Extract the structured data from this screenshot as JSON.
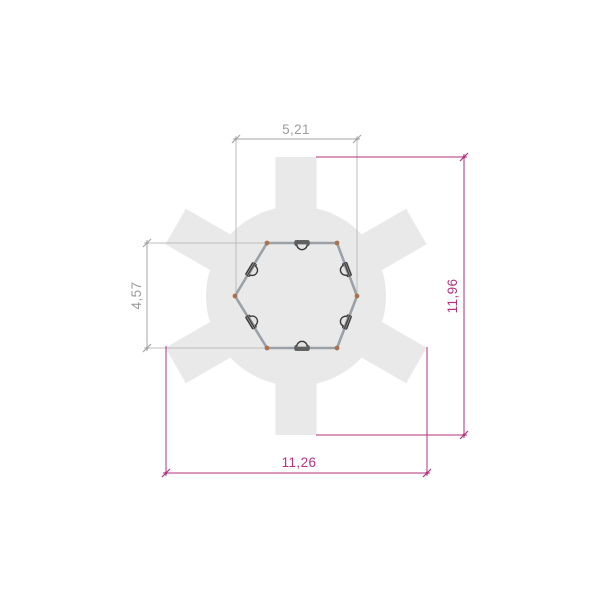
{
  "drawing": {
    "kind": "dimensioned top-view plan of hexagonal frame with six radiating platform arms",
    "dimensions": {
      "top": "5,21",
      "left": "4,57",
      "right": "11,96",
      "bottom": "11,26"
    }
  },
  "colors": {
    "shape_fill": "#e9e9e9",
    "hex_stroke": "#9ba1a6",
    "joint_dot": "#aa7350",
    "clamp_dark": "#3b3b3b",
    "dim_gray": "#a6a6a6",
    "dim_gray_text": "#9d9d9d",
    "dim_magenta": "#b5327f"
  }
}
